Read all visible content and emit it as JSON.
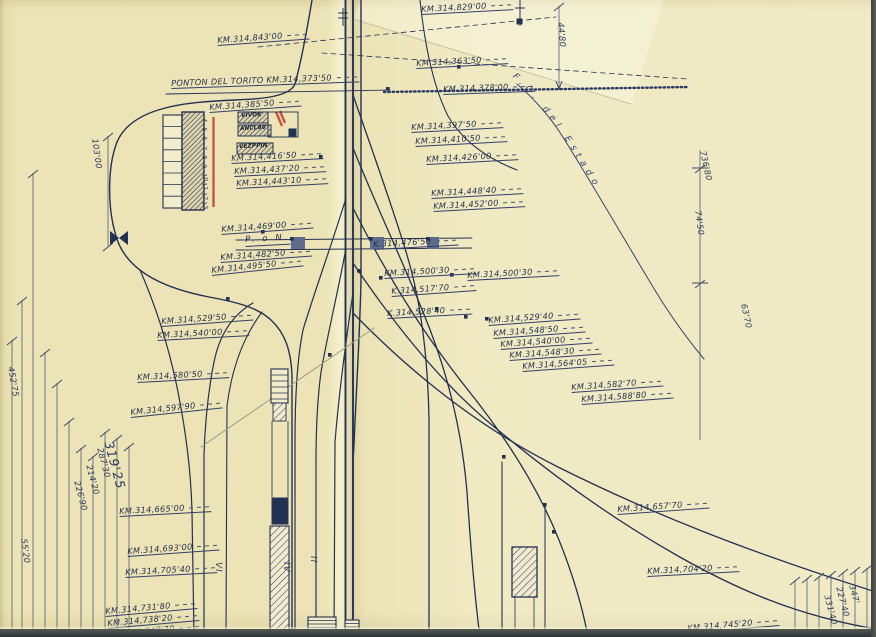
{
  "sheet": {
    "crossing_label": "P. o N.",
    "curve_label": "F.C. del Estado"
  },
  "colors": {
    "paper": "#ece4b6",
    "ink": "#233152",
    "ink_light": "#3a4a74",
    "pencil": "#9a9c8c",
    "red_mark": "#c43b2e"
  },
  "km_labels": [
    {
      "t": "KM.314,829'00",
      "x": 421,
      "y": 5,
      "r": -3
    },
    {
      "t": "KM.314,843'00",
      "x": 217,
      "y": 36,
      "r": -4
    },
    {
      "t": "KM.314,363'50",
      "x": 416,
      "y": 59,
      "r": -3
    },
    {
      "t": "PONTON DEL TORITO  KM.314,373'50",
      "x": 171,
      "y": 79,
      "r": -2
    },
    {
      "t": "KM.314,378'00",
      "x": 443,
      "y": 85,
      "r": -2
    },
    {
      "t": "KM.314,385'50",
      "x": 209,
      "y": 103,
      "r": -4
    },
    {
      "t": "KM.314,397'50",
      "x": 411,
      "y": 123,
      "r": -3
    },
    {
      "t": "KM.314,410'50",
      "x": 415,
      "y": 137,
      "r": -3
    },
    {
      "t": "KM.314,426'00",
      "x": 426,
      "y": 155,
      "r": -3
    },
    {
      "t": "KM.314,416'50",
      "x": 231,
      "y": 154,
      "r": -3
    },
    {
      "t": "KM.314,437'20",
      "x": 234,
      "y": 167,
      "r": -3
    },
    {
      "t": "KM.314,443'10",
      "x": 236,
      "y": 179,
      "r": -3
    },
    {
      "t": "KM.314,448'40",
      "x": 431,
      "y": 189,
      "r": -3
    },
    {
      "t": "KM.314,452'00",
      "x": 433,
      "y": 202,
      "r": -3
    },
    {
      "t": "KM.314,469'00",
      "x": 221,
      "y": 225,
      "r": -4
    },
    {
      "t": "K.314,476'50",
      "x": 373,
      "y": 240,
      "r": -3
    },
    {
      "t": "KM.314,482'50",
      "x": 220,
      "y": 253,
      "r": -4
    },
    {
      "t": "KM.314,495'50",
      "x": 211,
      "y": 266,
      "r": -6
    },
    {
      "t": "KM.314,500'30",
      "x": 384,
      "y": 269,
      "r": -3
    },
    {
      "t": "KM.314,500'30",
      "x": 467,
      "y": 271,
      "r": -3
    },
    {
      "t": "K.314,517'70",
      "x": 391,
      "y": 287,
      "r": -4
    },
    {
      "t": "K.314,528'40",
      "x": 387,
      "y": 309,
      "r": -3
    },
    {
      "t": "KM.314,529'40",
      "x": 488,
      "y": 316,
      "r": -4
    },
    {
      "t": "KM.314,548'50",
      "x": 493,
      "y": 329,
      "r": -4
    },
    {
      "t": "KM.314,540'00",
      "x": 500,
      "y": 340,
      "r": -4
    },
    {
      "t": "KM.314,548'30",
      "x": 509,
      "y": 351,
      "r": -4
    },
    {
      "t": "KM.314,564'05",
      "x": 522,
      "y": 362,
      "r": -4
    },
    {
      "t": "KM.314,529'50",
      "x": 161,
      "y": 317,
      "r": -4
    },
    {
      "t": "KM.314,540'00",
      "x": 157,
      "y": 331,
      "r": -3
    },
    {
      "t": "KM.314,580'50",
      "x": 137,
      "y": 373,
      "r": -3
    },
    {
      "t": "KM.314,597'90",
      "x": 130,
      "y": 408,
      "r": -6
    },
    {
      "t": "KM.314,582'70",
      "x": 571,
      "y": 383,
      "r": -4
    },
    {
      "t": "KM.314,588'80",
      "x": 581,
      "y": 395,
      "r": -4
    },
    {
      "t": "KM.314,657'70",
      "x": 617,
      "y": 505,
      "r": -4
    },
    {
      "t": "KM.314,665'00",
      "x": 119,
      "y": 507,
      "r": -3
    },
    {
      "t": "KM.314,693'00",
      "x": 127,
      "y": 547,
      "r": -4
    },
    {
      "t": "KM.314,705'40",
      "x": 125,
      "y": 568,
      "r": -3
    },
    {
      "t": "KM.314,704'20",
      "x": 647,
      "y": 567,
      "r": -3
    },
    {
      "t": "KM.314,731'80",
      "x": 105,
      "y": 607,
      "r": -5
    },
    {
      "t": "KM.314,738'20",
      "x": 107,
      "y": 619,
      "r": -5
    },
    {
      "t": "KM.314,748'70",
      "x": 109,
      "y": 630,
      "r": -5
    },
    {
      "t": "KM.314,745'20",
      "x": 687,
      "y": 624,
      "r": -5
    }
  ],
  "dim_labels": [
    {
      "t": "44'80",
      "x": 565,
      "y": 22,
      "r": 85
    },
    {
      "t": "103'00",
      "x": 99,
      "y": 138,
      "r": 82
    },
    {
      "t": "452'75",
      "x": 15,
      "y": 366,
      "r": 80
    },
    {
      "t": "319'25",
      "x": 114,
      "y": 440,
      "r": 75,
      "big": true
    },
    {
      "t": "287'30",
      "x": 104,
      "y": 447,
      "r": 75
    },
    {
      "t": "214'20",
      "x": 93,
      "y": 464,
      "r": 75
    },
    {
      "t": "226'90",
      "x": 81,
      "y": 480,
      "r": 75
    },
    {
      "t": "55'20",
      "x": 28,
      "y": 538,
      "r": 82
    },
    {
      "t": "736'80",
      "x": 707,
      "y": 150,
      "r": 78
    },
    {
      "t": "74'50",
      "x": 702,
      "y": 210,
      "r": 82
    },
    {
      "t": "63'70",
      "x": 748,
      "y": 303,
      "r": 78
    },
    {
      "t": "347'",
      "x": 856,
      "y": 584,
      "r": 75
    },
    {
      "t": "227'40",
      "x": 843,
      "y": 586,
      "r": 75
    },
    {
      "t": "331'40",
      "x": 831,
      "y": 594,
      "r": 75
    }
  ],
  "track_numbers": [
    {
      "t": "VI",
      "x": 222,
      "y": 562,
      "r": 90
    },
    {
      "t": "IV",
      "x": 290,
      "y": 562,
      "r": 90
    },
    {
      "t": "II",
      "x": 317,
      "y": 556,
      "r": 90
    }
  ],
  "building_numbers": [
    "4",
    "5",
    "6",
    "7",
    "8",
    "9",
    "10",
    "11",
    "12",
    "13"
  ],
  "structure_box_labels": [
    {
      "t": "VIVOK",
      "x": 241,
      "y": 114,
      "r": -2
    },
    {
      "t": "ANCLAV",
      "x": 240,
      "y": 127,
      "r": -2
    },
    {
      "t": "VEZPPIN",
      "x": 239,
      "y": 145,
      "r": -2
    }
  ]
}
